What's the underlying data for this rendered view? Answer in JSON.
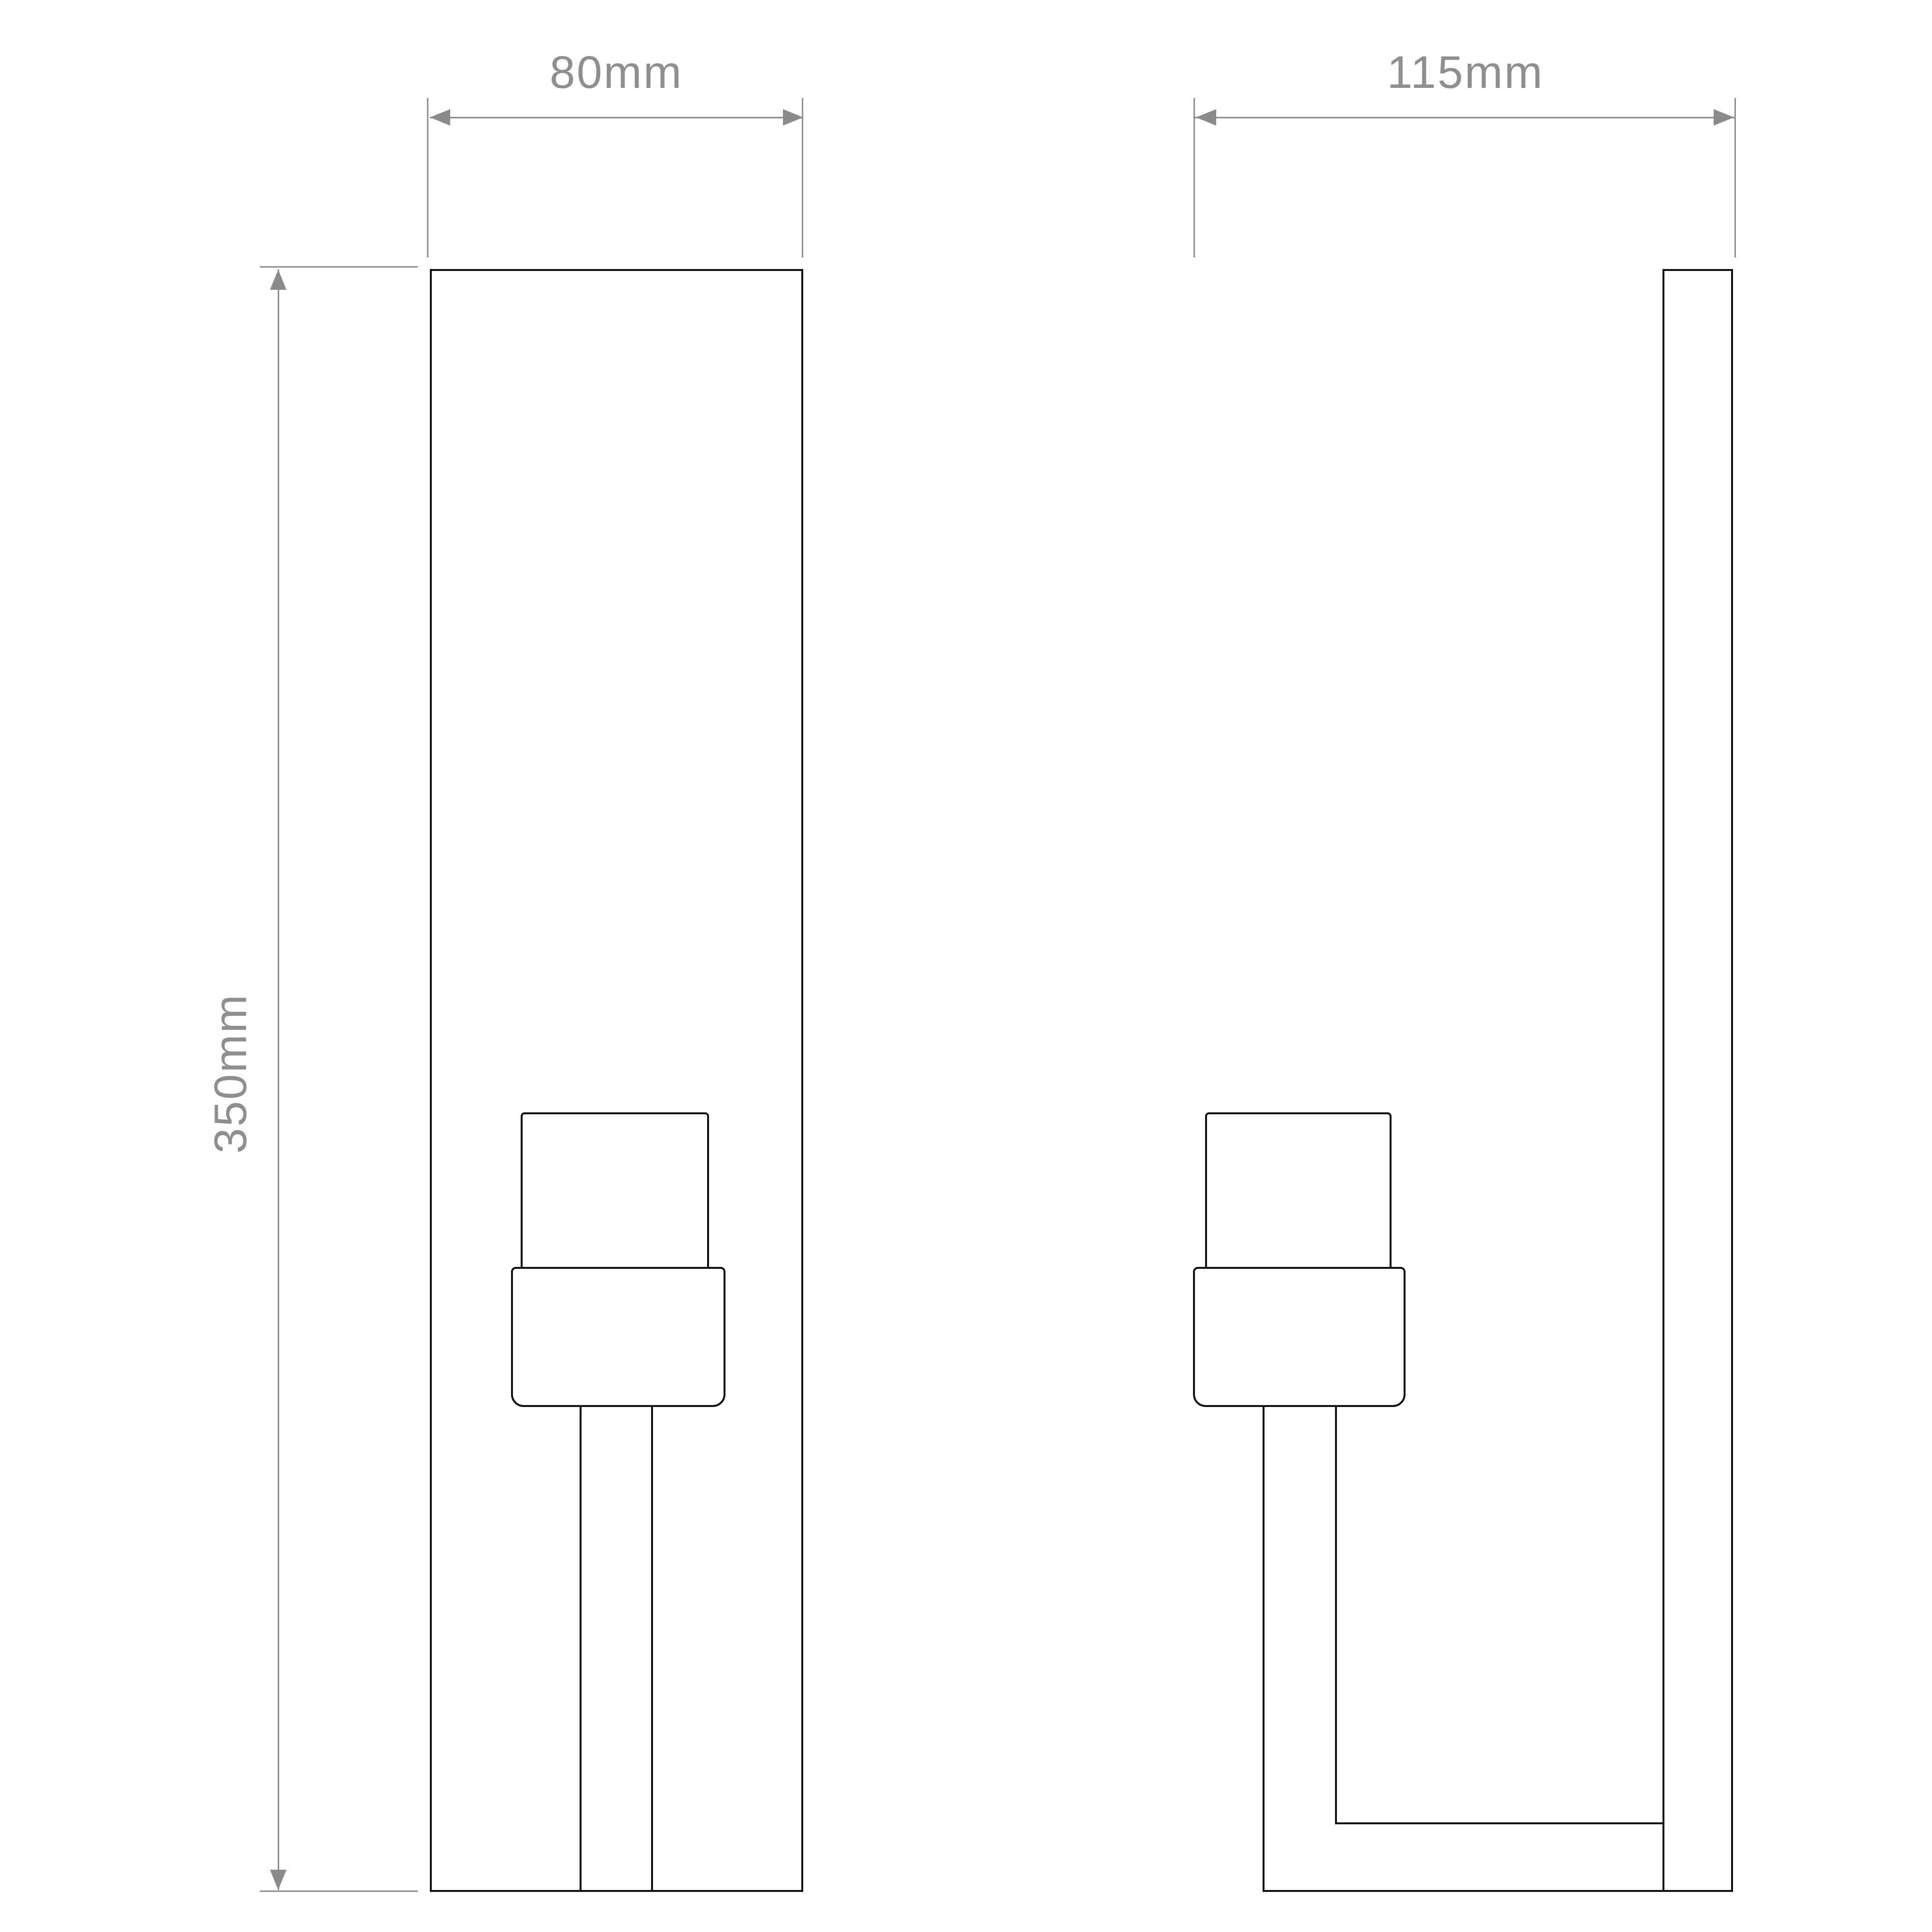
{
  "diagram": {
    "dimensions": {
      "front_width": "80mm",
      "side_depth": "115mm",
      "height": "350mm"
    },
    "colors": {
      "outline": "#111111",
      "dimension_lines": "#8a8a8a",
      "dimension_text": "#8f8f8f",
      "background": "#ffffff"
    }
  }
}
